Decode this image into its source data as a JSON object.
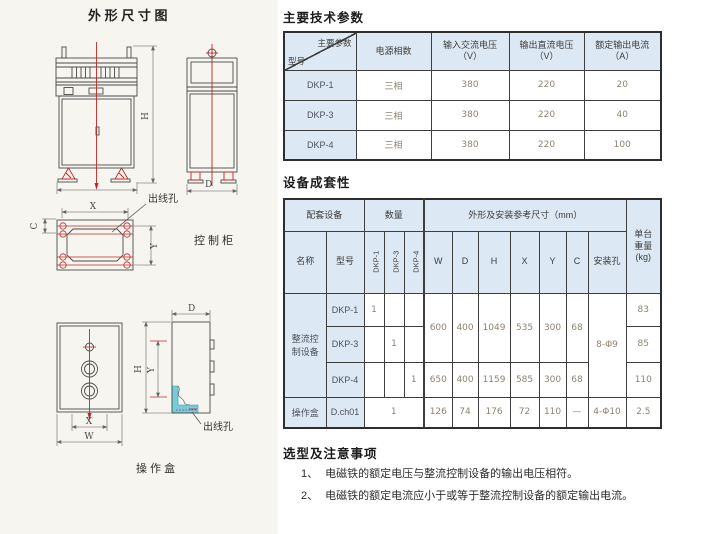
{
  "drawing": {
    "title": "外 形 尺 寸 图",
    "cabinet_label": "控 制 柜",
    "box_label": "操 作 盒",
    "outlet_hole_1": "出线孔",
    "outlet_hole_2": "出线孔",
    "dims": {
      "w": "W",
      "d": "D",
      "h": "H",
      "x": "X",
      "y": "Y",
      "c": "C"
    }
  },
  "sections": {
    "params": "主要技术参数",
    "completeness": "设备成套性",
    "notes": "选型及注意事项"
  },
  "params_table": {
    "corner_top": "主要参数",
    "corner_bottom": "型号",
    "col_phase": "电源相数",
    "col_vin_1": "输入交流电压",
    "col_vin_2": "（V）",
    "col_vout_1": "输出直流电压",
    "col_vout_2": "（V）",
    "col_iout_1": "额定输出电流",
    "col_iout_2": "（A）",
    "rows": [
      {
        "model": "DKP-1",
        "phase": "三相",
        "vin": "380",
        "vout": "220",
        "iout": "20"
      },
      {
        "model": "DKP-3",
        "phase": "三相",
        "vin": "380",
        "vout": "220",
        "iout": "40"
      },
      {
        "model": "DKP-4",
        "phase": "三相",
        "vin": "380",
        "vout": "220",
        "iout": "100"
      }
    ]
  },
  "comp_table": {
    "h_equipment": "配套设备",
    "h_qty": "数量",
    "h_dims": "外形及安装参考尺寸（mm）",
    "h_weight_1": "单台",
    "h_weight_2": "重量",
    "h_weight_3": "(kg)",
    "h_name": "名称",
    "h_model": "型号",
    "h_q1": "DKP-1",
    "h_q2": "DKP-3",
    "h_q3": "DKP-4",
    "h_w": "W",
    "h_d": "D",
    "h_h": "H",
    "h_x": "X",
    "h_y": "Y",
    "h_c": "C",
    "h_hole": "安装孔",
    "group_name_1": "整流控",
    "group_name_2": "制设备",
    "rows": {
      "r1": {
        "model": "DKP-1",
        "q1": "1",
        "w": "600",
        "d": "400",
        "h": "1049",
        "x": "535",
        "y": "300",
        "c": "68",
        "hole": "8-Φ9",
        "wt": "83"
      },
      "r2": {
        "model": "DKP-3",
        "q2": "1",
        "wt": "85"
      },
      "r3": {
        "model": "DKP-4",
        "q3": "1",
        "w": "650",
        "d": "400",
        "h": "1159",
        "x": "585",
        "y": "300",
        "c": "68",
        "wt": "110"
      },
      "r4": {
        "name": "操作盒",
        "model": "D.ch01",
        "q": "1",
        "w": "126",
        "d": "74",
        "h": "176",
        "x": "72",
        "y": "110",
        "c": "—",
        "hole": "4-Φ10",
        "wt": "2.5"
      }
    }
  },
  "notes": {
    "items": [
      {
        "marker": "1、",
        "text": "电磁铁的额定电压与整流控制设备的输出电压相符。"
      },
      {
        "marker": "2、",
        "text": "电磁铁的额定电流应小于或等于整流控制设备的额定输出电流。"
      }
    ]
  },
  "colors": {
    "header_fill": "#dce8f4",
    "centerline_red": "#c22626",
    "highlight_cyan": "#76ccdb"
  }
}
